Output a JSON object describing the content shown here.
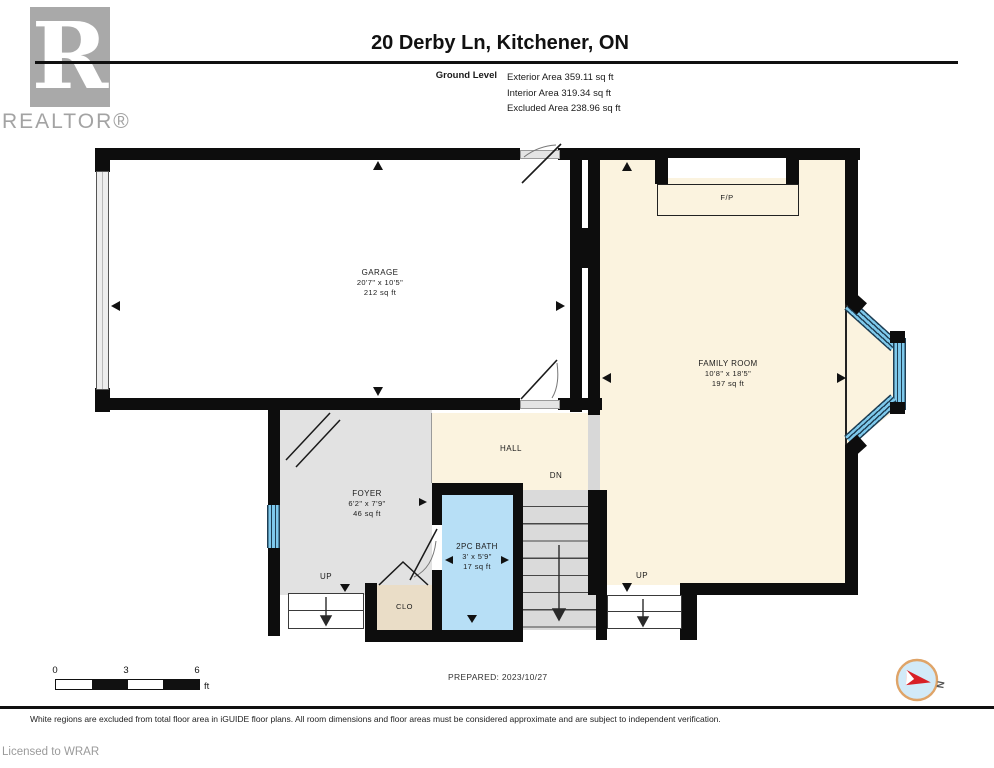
{
  "header": {
    "brand_logo_letter": "R",
    "brand_name": "REALTOR®",
    "title": "20 Derby Ln, Kitchener, ON",
    "level_label": "Ground Level",
    "area_lines": [
      "Exterior Area 359.11 sq ft",
      "Interior Area 319.34 sq ft",
      "Excluded Area 238.96 sq ft"
    ]
  },
  "rooms": {
    "garage": {
      "name": "GARAGE",
      "dims": "20'7\" x 10'5\"",
      "area": "212 sq ft"
    },
    "family_room": {
      "name": "FAMILY ROOM",
      "dims": "10'8\" x 18'5\"",
      "area": "197 sq ft"
    },
    "foyer": {
      "name": "FOYER",
      "dims": "6'2\" x 7'9\"",
      "area": "46 sq ft"
    },
    "bath": {
      "name": "2PC BATH",
      "dims": "3' x 5'9\"",
      "area": "17 sq ft"
    },
    "hall": {
      "name": "HALL"
    },
    "closet": {
      "name": "CLO"
    },
    "fireplace": {
      "name": "F/P"
    }
  },
  "labels": {
    "up": "UP",
    "dn": "DN",
    "north": "N"
  },
  "scale_bar": {
    "ticks": [
      "0",
      "3",
      "6"
    ],
    "unit": "ft"
  },
  "footer": {
    "prepared": "PREPARED: 2023/10/27",
    "disclaimer": "White regions are excluded from total floor area in iGUIDE floor plans. All room dimensions and floor areas must be considered approximate and are subject to independent verification.",
    "licensed": "Licensed to WRAR"
  },
  "colors": {
    "interior": "#FBF3DF",
    "excluded_gray": "#E2E2E2",
    "closet_tan": "#EADDC7",
    "bath_blue": "#B7DFF6",
    "window_blue": "#7EC9EC",
    "wall": "#0D0D0D"
  }
}
